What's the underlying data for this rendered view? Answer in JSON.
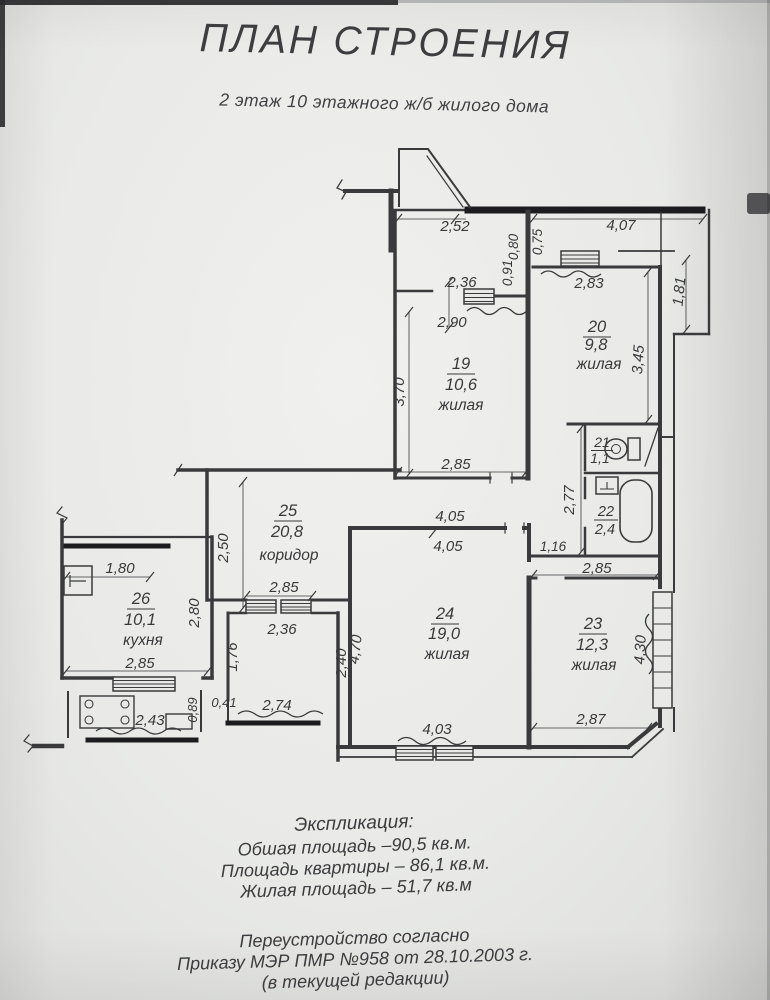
{
  "title": "ПЛАН СТРОЕНИЯ",
  "subtitle": "2 этаж 10 этажного ж/б жилого дома",
  "rooms": [
    {
      "num": "19",
      "area": "10,6",
      "label": "жилая"
    },
    {
      "num": "20",
      "area": "9,8",
      "label": "жилая"
    },
    {
      "num": "21",
      "area": "1,1",
      "label": ""
    },
    {
      "num": "22",
      "area": "2,4",
      "label": ""
    },
    {
      "num": "23",
      "area": "12,3",
      "label": "жилая"
    },
    {
      "num": "24",
      "area": "19,0",
      "label": "жилая"
    },
    {
      "num": "25",
      "area": "20,8",
      "label": "коридор"
    },
    {
      "num": "26",
      "area": "10,1",
      "label": "кухня"
    }
  ],
  "dims": {
    "t252": "2,52",
    "v080": "0,80",
    "v075": "0,75",
    "t407": "4,07",
    "v091": "0,91",
    "r19w236": "2,36",
    "r19w290": "2,90",
    "r20w283": "2,83",
    "balc181": "1,81",
    "r19h370": "3,70",
    "r20h345": "3,45",
    "r19b285": "2,85",
    "pocket277": "2,77",
    "cor250": "2,50",
    "r24t405a": "4,05",
    "r24t405b": "4,05",
    "pocket116": "1,16",
    "r23t285": "2,85",
    "corb285": "2,85",
    "kit180": "1,80",
    "kit280": "2,80",
    "kitb285": "2,85",
    "tam176": "1,76",
    "tam236": "2,36",
    "tam240": "2,40",
    "r24h470": "4,70",
    "gap041": "0,41",
    "log274": "2,74",
    "balc089": "0,89",
    "balc243": "2,43",
    "r24b403": "4,03",
    "r23b287": "2,87",
    "r23w430": "4,30"
  },
  "explication": {
    "heading": "Экспликация:",
    "line1": "Обшая площадь –90,5 кв.м.",
    "line2": "Площадь квартиры – 86,1 кв.м.",
    "line3": "Жилая площадь – 51,7 кв.м"
  },
  "note": {
    "line1": "Переустройство согласно",
    "line2": "Приказу МЭР ПМР №958 от 28.10.2003 г.",
    "line3": "(в текущей редакции)"
  },
  "colors": {
    "ink": "#3a3a3c",
    "dark": "#1c1c1e",
    "paper": "#e9eae8"
  }
}
